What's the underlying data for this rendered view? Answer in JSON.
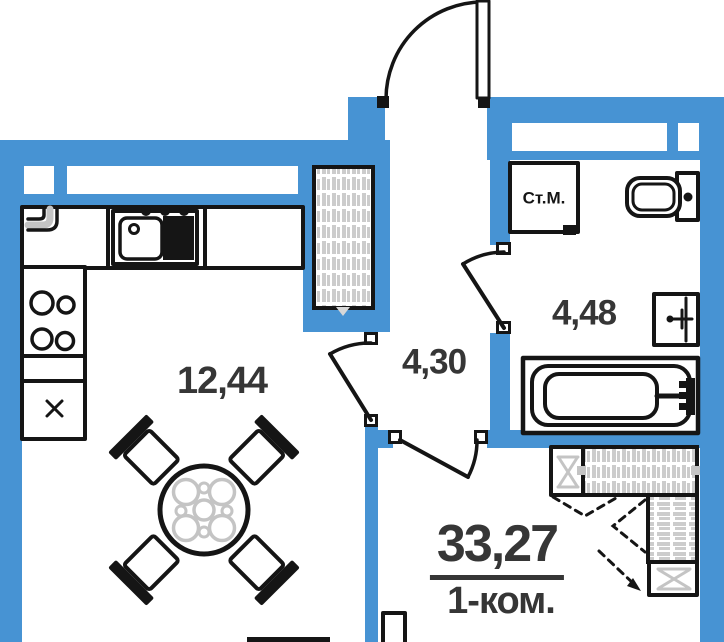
{
  "plan": {
    "rooms": {
      "kitchen_living": {
        "area": "12,44"
      },
      "hallway": {
        "area": "4,30"
      },
      "bathroom": {
        "area": "4,48"
      }
    },
    "appliances": {
      "washing_machine": "Ст.М."
    },
    "summary": {
      "total_area": "33,27",
      "apartment_type": "1-ком."
    },
    "colors": {
      "wall": "#4793D3",
      "outline": "#151515",
      "hatch": "#cccccc",
      "furniture_gray": "#c4c4c4",
      "text": "#363636",
      "background": "#ffffff"
    }
  }
}
